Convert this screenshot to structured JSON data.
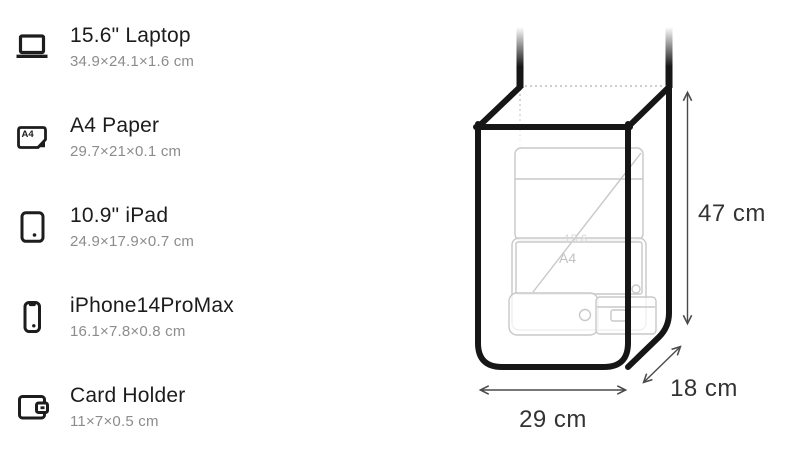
{
  "items": [
    {
      "name": "15.6\" Laptop",
      "dims": "34.9×24.1×1.6 cm",
      "icon": "laptop-icon"
    },
    {
      "name": "A4 Paper",
      "dims": "29.7×21×0.1 cm",
      "icon": "a4-paper-icon",
      "icon_label": "A4"
    },
    {
      "name": "10.9\" iPad",
      "dims": "24.9×17.9×0.7 cm",
      "icon": "ipad-icon"
    },
    {
      "name": "iPhone14ProMax",
      "dims": "16.1×7.8×0.8 cm",
      "icon": "iphone-icon"
    },
    {
      "name": "Card Holder",
      "dims": "11×7×0.5 cm",
      "icon": "card-holder-icon"
    }
  ],
  "diagram": {
    "height_label": "47 cm",
    "width_label": "29 cm",
    "depth_label": "18 cm",
    "inside_labels": {
      "a4": "A4",
      "laptop": "15.6"
    },
    "colors": {
      "outline": "#161616",
      "ghost_outline": "#c8c8c8",
      "dotted": "#bdbdbd",
      "arrow": "#4a4a4a",
      "label": "#333333",
      "title_text": "#1c1c1c",
      "subtitle_text": "#8c8c8c"
    }
  }
}
